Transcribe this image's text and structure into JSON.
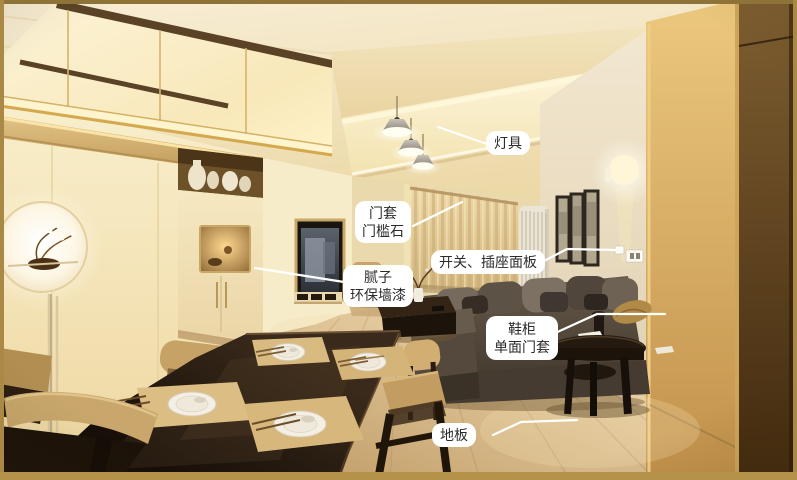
{
  "annotations": {
    "lamp": {
      "label": "灯具"
    },
    "door_casing": {
      "line1": "门套",
      "line2": "门槛石"
    },
    "switch_panel": {
      "label": "开关、插座面板"
    },
    "wall_putty": {
      "line1": "腻子",
      "line2": "环保墙漆"
    },
    "shoe_cabinet": {
      "line1": "鞋柜",
      "line2": "单面门套"
    },
    "floor": {
      "label": "地板"
    }
  },
  "colors": {
    "frame_border_top": "#8e7338",
    "frame_border_side": "#a98945",
    "frame_border_bottom": "#b5924a",
    "label_background": "#ffffff",
    "label_text": "#2b2b2b",
    "leader_line": "#ffffff"
  }
}
